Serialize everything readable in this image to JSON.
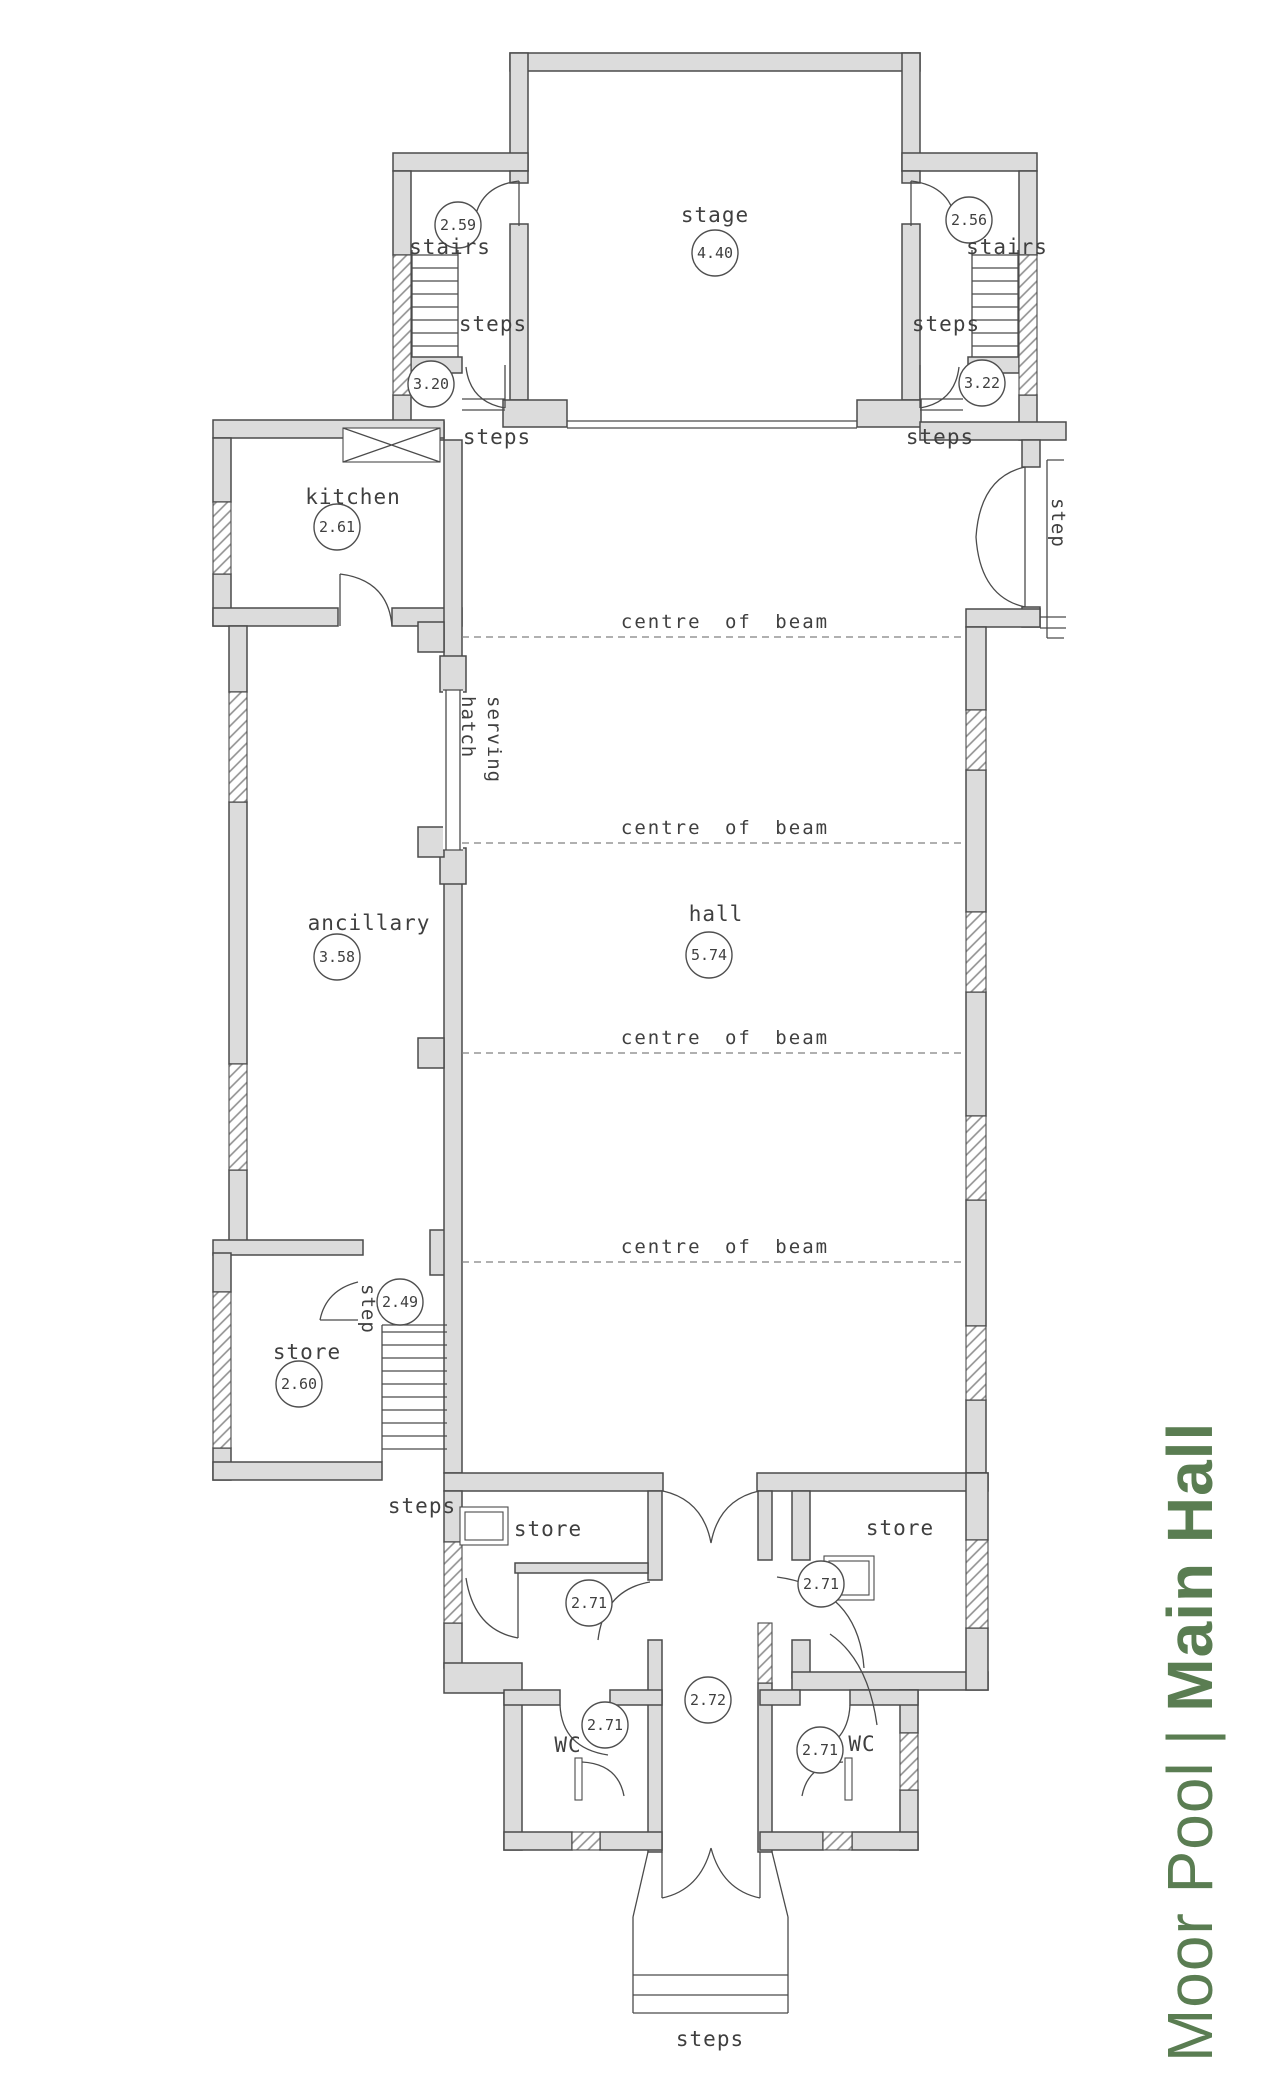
{
  "title": {
    "light": "Moor Pool",
    "sep": "|",
    "bold": "Main Hall"
  },
  "colors": {
    "title_green": "#5a7d52",
    "wall_fill": "#dcdcdc",
    "line": "#4b4b4b"
  },
  "labels": {
    "stage": "stage",
    "stairs_left": "stairs",
    "stairs_right": "stairs",
    "steps_room_left": "steps",
    "steps_room_right": "steps",
    "steps_hall_left": "steps",
    "steps_hall_right": "steps",
    "kitchen": "kitchen",
    "serving_line1": "serving",
    "serving_line2": "hatch",
    "hall": "hall",
    "ancillary": "ancillary",
    "beam": "centre of beam",
    "step_exterior": "step",
    "step_store": "step",
    "store_sw": "store",
    "steps_sw": "steps",
    "store_left": "store",
    "store_right": "store",
    "wc_left": "WC",
    "wc_right": "WC",
    "steps_entrance": "steps"
  },
  "dimensions": {
    "stage": "4.40",
    "stairs_left": "2.59",
    "stairs_right": "2.56",
    "landing_left": "3.20",
    "landing_right": "3.22",
    "kitchen": "2.61",
    "hall": "5.74",
    "ancillary": "3.58",
    "step_lobby": "2.49",
    "store_sw": "2.60",
    "lobby_left": "2.71",
    "wc_left": "2.71",
    "corridor": "2.72",
    "store_right": "2.71",
    "wc_right": "2.71"
  }
}
